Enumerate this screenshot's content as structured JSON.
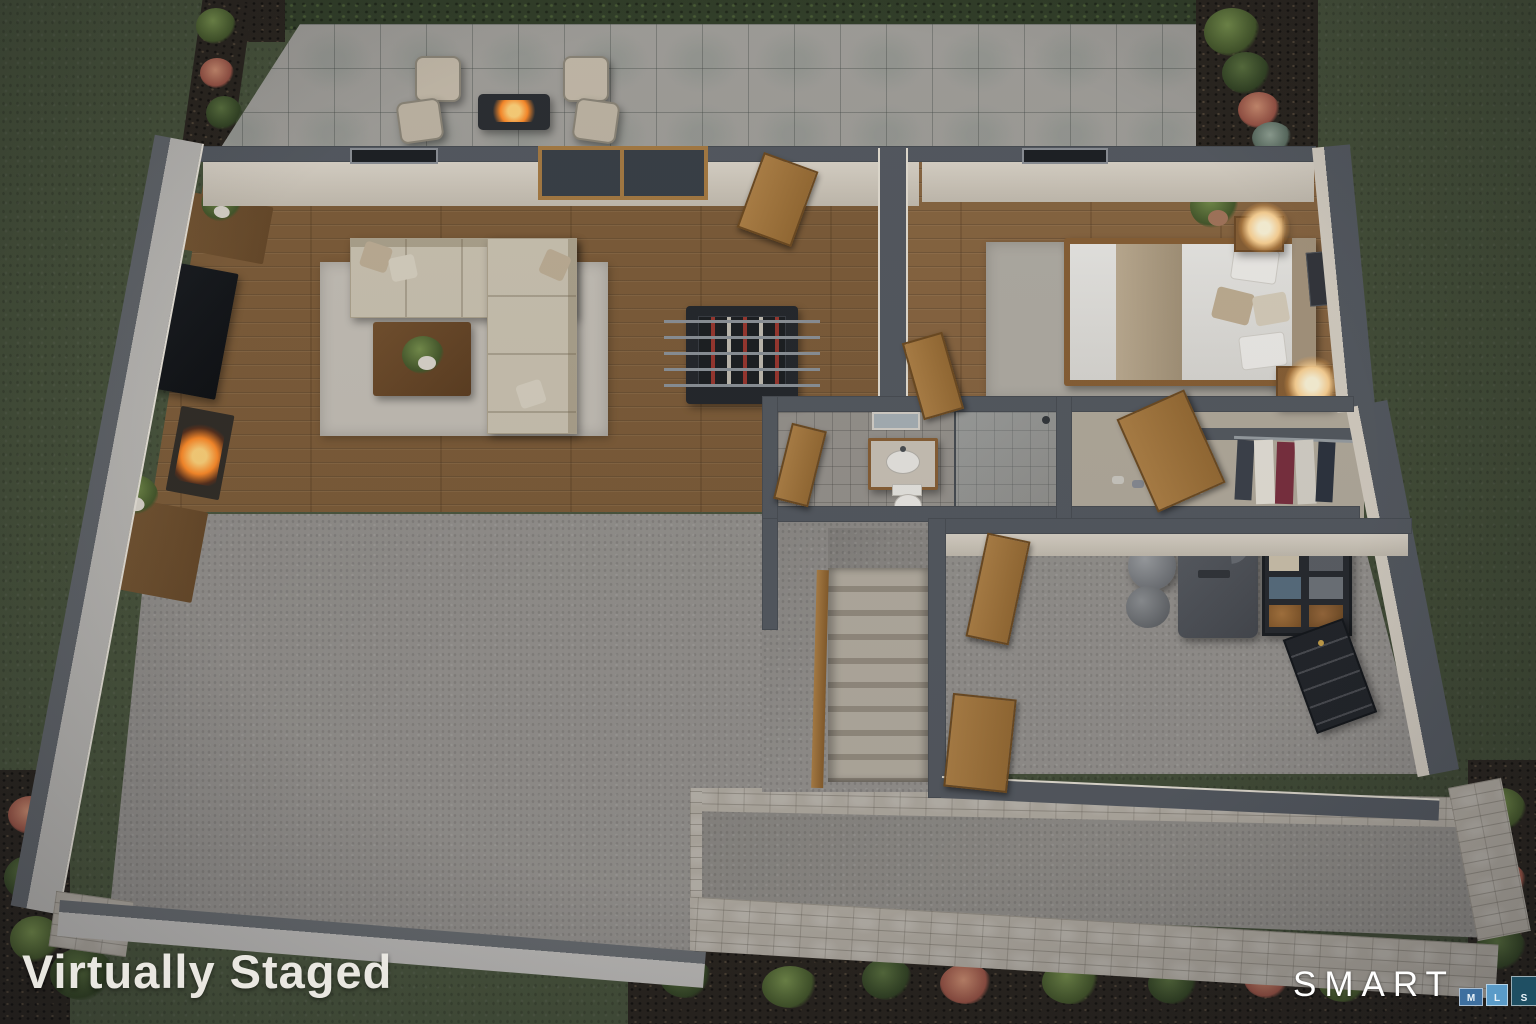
{
  "watermark": {
    "text": "Virtually Staged",
    "color": "#e9e7e1"
  },
  "logo": {
    "brand": "SMART",
    "blocks": [
      {
        "label": "M",
        "color": "#3e6f9f"
      },
      {
        "label": "L",
        "color": "#5a9bc8"
      },
      {
        "label": "S",
        "color": "#1f4f63"
      }
    ]
  },
  "scene": {
    "type": "aerial-3d-floorplan-render",
    "setting": "virtually staged walk-out basement level with backyard patio at dusk",
    "rooms": [
      "patio",
      "living-room",
      "game-area",
      "bedroom",
      "bathroom",
      "walk-in-closet",
      "utility-room",
      "staircase",
      "unfinished-basement",
      "walkout-walkway"
    ],
    "furnishings": {
      "patio": [
        "two pairs of lounge chairs",
        "rectangular fire pit table with flame",
        "stone pavers",
        "hedge border"
      ],
      "living_room": [
        "L-shaped sectional sofa with pillows",
        "area rug",
        "square wood coffee table with plant",
        "media wall with TV",
        "lit fireplace",
        "potted plants"
      ],
      "game_area": [
        "foosball table"
      ],
      "bedroom": [
        "platform bed with white duvet and tan throw",
        "two nightstands with lit lamps",
        "area rug",
        "potted plant",
        "wall art"
      ],
      "bathroom": [
        "vanity with sink",
        "mirror",
        "toilet",
        "glass shower enclosure"
      ],
      "walk_in_closet": [
        "hanging clothes in charcoal, white, maroon and navy",
        "row of shoes",
        "wood door"
      ],
      "utility_room": [
        "water heater",
        "furnace with duct",
        "black storage shelf with bins",
        "tool chest"
      ],
      "staircase": [
        "carpeted stairs",
        "wood handrail",
        "wood doors"
      ]
    }
  },
  "palette": {
    "grass": "#4d5940",
    "hedge": "#33402a",
    "soil": "#2b2620",
    "patio_tile": "#a3a19c",
    "wood_floor": "#7f5e3a",
    "concrete": "#979490",
    "bath_tile": "#99958f",
    "wall_top": "#565b62",
    "wall_face": "#d7d0c4",
    "exterior_wall": "#b9b7b3",
    "stone_wall": "#b4aea4",
    "door_wood": "#a87c44",
    "sofa": "#cdc5b3",
    "rug": "#c6c1b8",
    "fire": "#ff8c2a",
    "lamp_glow": "#ffd9a0"
  }
}
